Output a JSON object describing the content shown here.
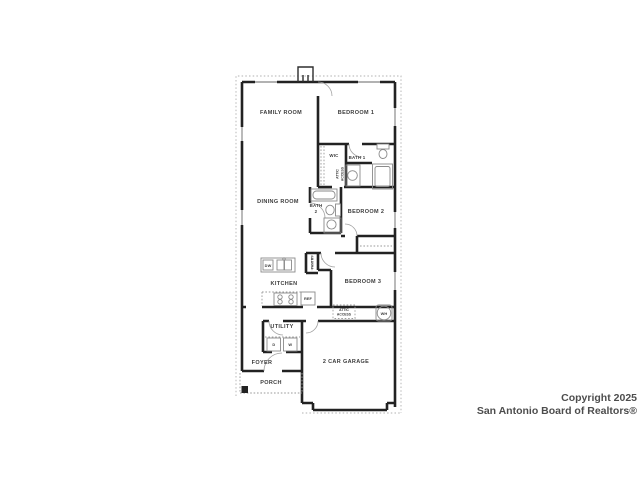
{
  "watermark": {
    "line1": "Copyright 2025",
    "line2": "San Antonio Board of Realtors®"
  },
  "rooms": {
    "family_room": "FAMILY ROOM",
    "bedroom1": "BEDROOM 1",
    "wic": "WIC",
    "bath1": "BATH 1",
    "dining_room": "DINING ROOM",
    "bath2_line1": "BATH",
    "bath2_line2": "2",
    "bedroom2": "BEDROOM 2",
    "bedroom3": "BEDROOM 3",
    "kitchen": "KITCHEN",
    "utility": "UTILITY",
    "foyer": "FOYER",
    "porch": "PORCH",
    "garage": "2 CAR GARAGE"
  },
  "labels": {
    "attic_hall_line1": "ATTIC",
    "attic_hall_line2": "ACCESS",
    "attic_garage_line1": "ATTIC",
    "attic_garage_line2": "ACCESS",
    "pantry": "PANTRY",
    "dishwasher": "DW",
    "refrigerator": "REF",
    "water_heater": "WH",
    "dryer": "D",
    "washer": "W"
  },
  "colors": {
    "wall": "#222222",
    "fixture": "#8a8a8a",
    "label": "#3c3c3c",
    "watermark": "#4d4d4d",
    "background": "#ffffff"
  }
}
